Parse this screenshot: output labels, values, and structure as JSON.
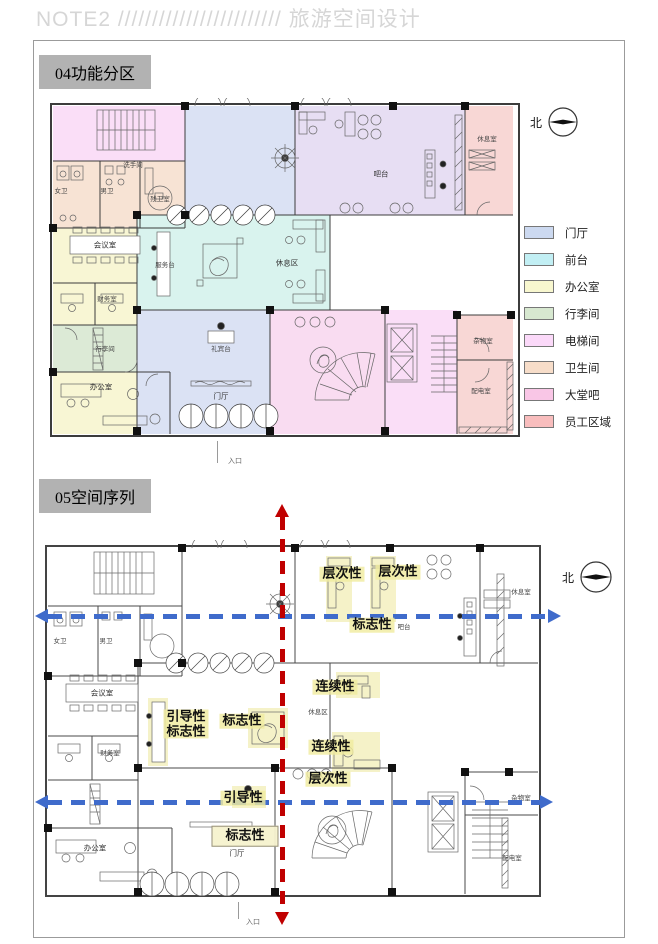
{
  "header": {
    "title": "NOTE2 //////////////////////// 旅游空间设计"
  },
  "zone_colors": {
    "lobby": "#dbe2f4",
    "front_desk": "#d9f3ee",
    "office": "#f8f6d4",
    "luggage": "#dcead6",
    "elevator": "#fadef7",
    "toilet": "#f7e3d4",
    "lobby_bar": "#f9dcf1",
    "staff": "#f8d7d5",
    "bar_top": "#e7def3"
  },
  "section1": {
    "title": "04功能分区",
    "north": "北",
    "entrance": "入口",
    "rooms": {
      "female_wc": "女卫",
      "male_wc": "男卫",
      "washroom": "洗手间",
      "accessible_wc": "残卫室",
      "meeting_room": "会议室",
      "finance_room": "财务室",
      "luggage_room": "行李间",
      "office": "办公室",
      "service_desk": "服务台",
      "rest_area": "休息区",
      "concierge_desk": "礼宾台",
      "lobby": "门厅",
      "bar_counter": "吧台",
      "staff_lounge": "休息室",
      "storage_room": "杂物室",
      "power_room": "配电室"
    },
    "legend": {
      "items": [
        {
          "label": "门厅",
          "color": "#ccd9f0"
        },
        {
          "label": "前台",
          "color": "#c2eff4"
        },
        {
          "label": "办公室",
          "color": "#f8f7cf"
        },
        {
          "label": "行李间",
          "color": "#d7e8d0"
        },
        {
          "label": "电梯间",
          "color": "#fbd9f9"
        },
        {
          "label": "卫生间",
          "color": "#f7ddc9"
        },
        {
          "label": "大堂吧",
          "color": "#f9c6e6"
        },
        {
          "label": "员工区域",
          "color": "#f8bdbd"
        }
      ]
    }
  },
  "section2": {
    "title": "05空间序列",
    "north": "北",
    "entrance": "入口",
    "rooms": {
      "female_wc": "女卫",
      "male_wc": "男卫",
      "meeting_room": "会议室",
      "finance_room": "财务室",
      "office": "办公室",
      "rest_area": "休息区",
      "bar_counter": "吧台",
      "staff_lounge": "休息室",
      "storage_room": "杂物室",
      "power_room": "配电室",
      "lobby": "门厅"
    },
    "annotations": {
      "hierarchy_1": "层次性",
      "hierarchy_2": "层次性",
      "landmark_1": "标志性",
      "continuity_1": "连续性",
      "continuity_2": "连续性",
      "hierarchy_3": "层次性",
      "guide_line1": "引导性",
      "guide_line2": "标志性",
      "landmark_2": "标志性",
      "guidance_2": "引导性",
      "landmark_3": "标志性"
    },
    "axis_colors": {
      "blue": "#3f6bcb",
      "red": "#c00000"
    }
  }
}
